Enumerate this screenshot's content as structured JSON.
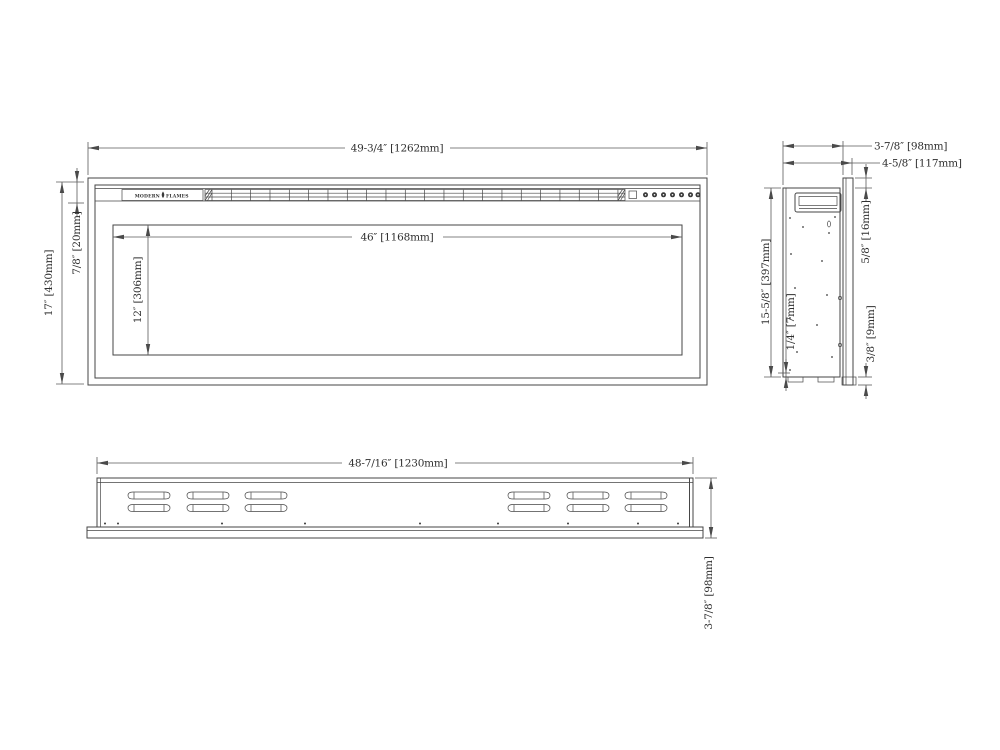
{
  "drawing": {
    "brand_left": "MODERN",
    "brand_right": "FLAMES",
    "front": {
      "overall_width": "49-3/4″ [1262mm]",
      "viewing_width": "46″ [1168mm]",
      "viewing_height": "12″ [306mm]",
      "overall_height": "17″ [430mm]",
      "top_bezel": "7/8″ [20mm]"
    },
    "side": {
      "body_depth": "3-7/8″ [98mm]",
      "overall_depth": "4-5/8″ [117mm]",
      "front_lip": "5/8″ [16mm]",
      "body_height": "15-5/8″ [397mm]",
      "bottom_gap": "1/4″ [7mm]",
      "bottom_lip": "3/8″ [9mm]"
    },
    "bottom": {
      "body_width": "48-7/16″ [1230mm]",
      "body_depth": "3-7/8″ [98mm]"
    }
  }
}
